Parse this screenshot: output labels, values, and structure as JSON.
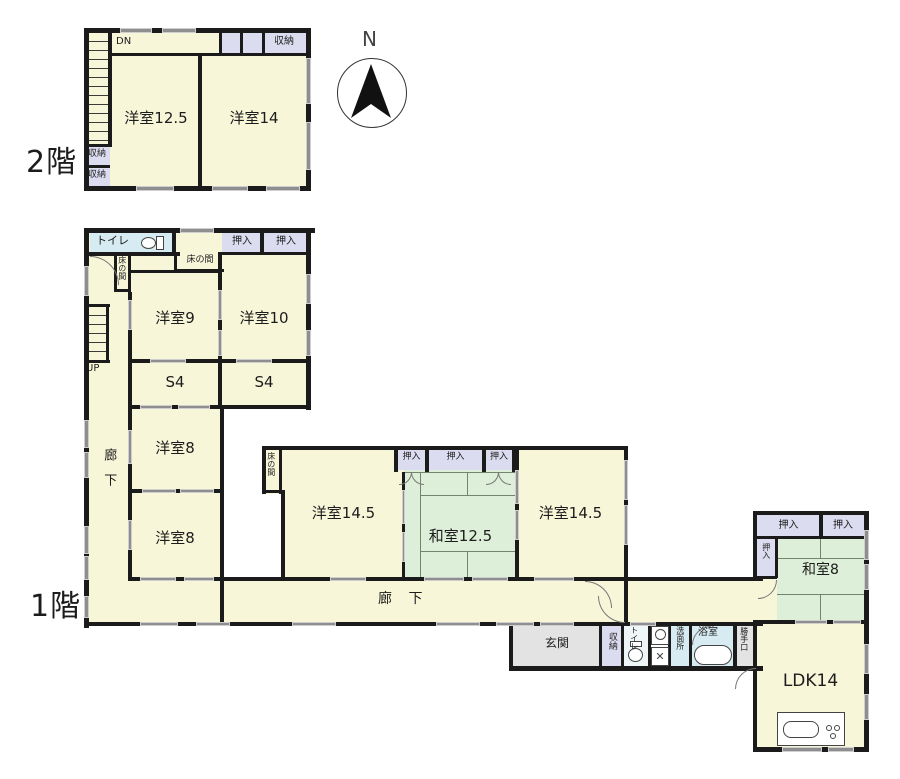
{
  "compass": {
    "north": "N"
  },
  "floor2": {
    "floor_label": "2階",
    "stairs": "DN",
    "room_yoshitsu_125": "洋室12.5",
    "room_yoshitsu_14": "洋室14",
    "closet_top": "収納",
    "closet_left_1": "収納",
    "closet_left_2": "収納"
  },
  "floor1": {
    "floor_label": "1階",
    "stairs": "UP",
    "toilet_top": "トイレ",
    "oshiire_top_1": "押入",
    "oshiire_top_2": "押入",
    "tokonoma_small": "床の間",
    "tokonoma_top": "床の間",
    "room_yoshitsu_9": "洋室9",
    "room_yoshitsu_10": "洋室10",
    "room_s4_left": "S4",
    "room_s4_right": "S4",
    "corridor_vertical": "廊下",
    "room_yoshitsu_8_upper": "洋室8",
    "room_yoshitsu_8_lower": "洋室8",
    "tokonoma_mid": "床の間",
    "room_yoshitsu_145_left": "洋室14.5",
    "oshiire_mid_1": "押入",
    "oshiire_mid_2": "押入",
    "oshiire_mid_3": "押入",
    "room_washitsu_125": "和室12.5",
    "room_yoshitsu_145_right": "洋室14.5",
    "corridor_horizontal": "廊 下",
    "oshiire_right_1": "押入",
    "oshiire_right_2": "押入",
    "oshiire_right_side": "押入",
    "room_washitsu_8": "和室8",
    "genkan": "玄関",
    "closet_genkan": "収納",
    "toilet_small": "トイレ",
    "senmenjo": "洗面所",
    "bathroom": "浴室",
    "katteguchi": "勝手口",
    "room_ldk": "LDK14"
  }
}
